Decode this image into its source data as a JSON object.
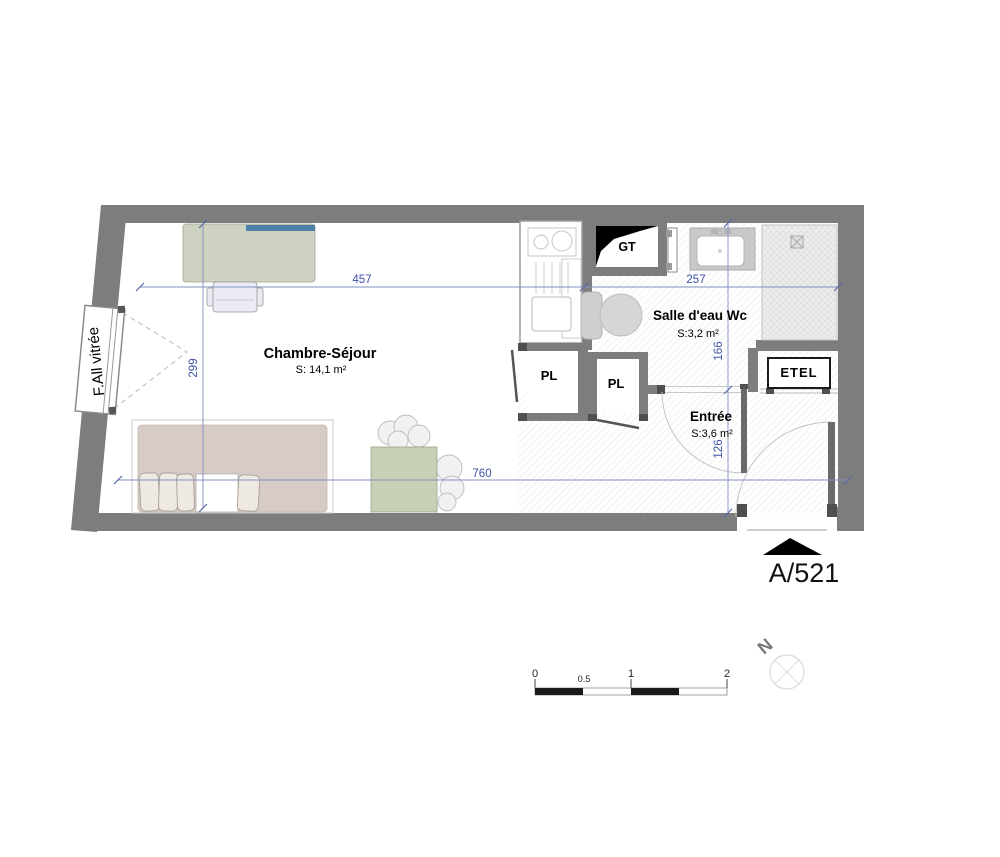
{
  "plan": {
    "rooms": [
      {
        "name": "Chambre-Séjour",
        "area": "S: 14,1 m²"
      },
      {
        "name": "Salle d'eau Wc",
        "area": "S:3,2 m²"
      },
      {
        "name": "Entrée",
        "area": "S:3,6 m²"
      }
    ],
    "features": {
      "gt": "GT",
      "pl1": "PL",
      "pl2": "PL",
      "etel": "ETEL",
      "window": "F.All vitrée"
    },
    "dimensions": {
      "chambre_width": "457",
      "salle_eau_width": "257",
      "chambre_height": "299",
      "total_width": "760",
      "salle_eau_height": "166",
      "entree_height": "126"
    },
    "reference": "A/521",
    "north_label": "N"
  },
  "scale_bar": {
    "labels": [
      "0",
      "0.5",
      "1",
      "2"
    ]
  },
  "colors": {
    "wall_gray": "#7d7d7d",
    "dark_stub": "#4f4f4f",
    "dimension_blue": "#3d51a5",
    "desk_green": "#cdd3c0",
    "table_green": "#c9d0b8",
    "shelf_blue": "#4d7fa8",
    "duvet_beige": "#d6ccc5",
    "fixture_gray": "#cfcfcf",
    "annotation_black": "#000000"
  }
}
